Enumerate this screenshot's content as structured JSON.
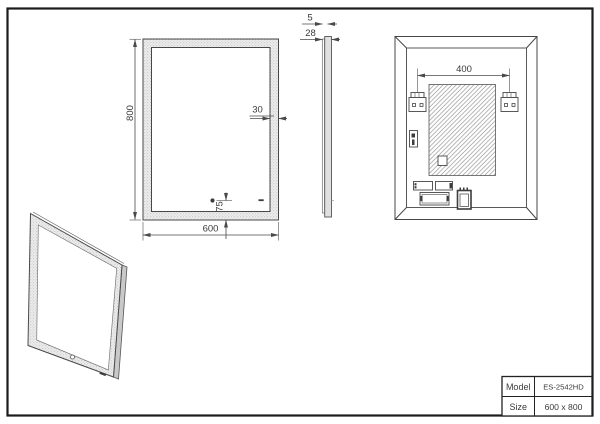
{
  "dimensions": {
    "mirror_height": "800",
    "mirror_width": "600",
    "frame_width": "30",
    "sensor_offset": "75",
    "glass_thickness": "5",
    "mirror_depth": "28",
    "bracket_spacing": "400"
  },
  "title_block": {
    "rows": [
      {
        "label": "Model",
        "value": "ES-2542HD"
      },
      {
        "label": "Size",
        "value": "600 x 800"
      }
    ]
  },
  "colors": {
    "line": "#474747",
    "dimension_line": "#4a4a4a",
    "frame_fill": "#ededed",
    "hatch_line": "#808080",
    "page_border": "#1b1b1b"
  }
}
